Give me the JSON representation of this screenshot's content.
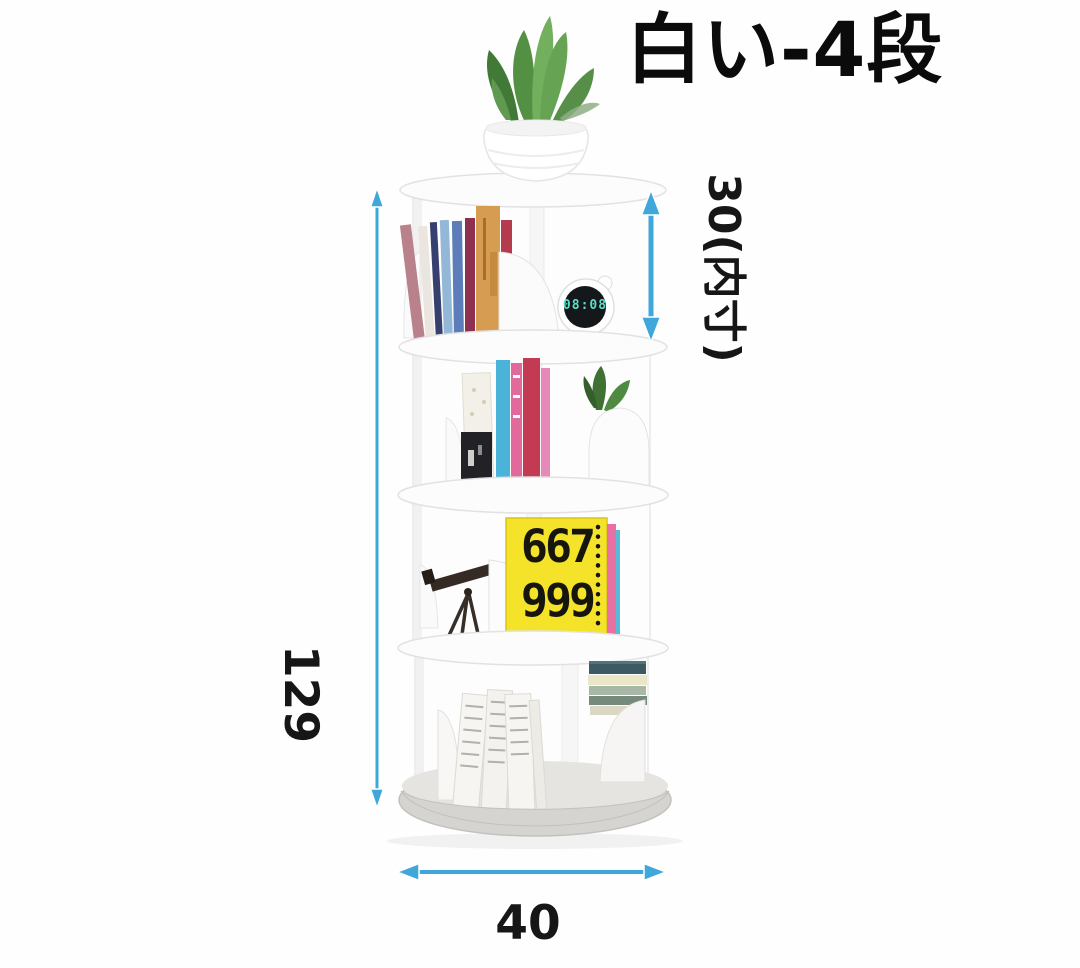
{
  "title": "白い-4段",
  "dimensions": {
    "height": "129",
    "inner_height": "30(内寸)",
    "width": "40"
  },
  "objects": {
    "clock_time": "08:08",
    "yellow_book_number_top": "667",
    "yellow_book_number_bottom": "999"
  },
  "colors": {
    "arrow_blue": "#3fa7d9",
    "yellow_book": "#f4e329",
    "clock_digits": "#5bdcc6",
    "shelf_white": "#fdfdfd",
    "base_gray": "#d6d4d1",
    "title_black": "#0b0b0b"
  }
}
